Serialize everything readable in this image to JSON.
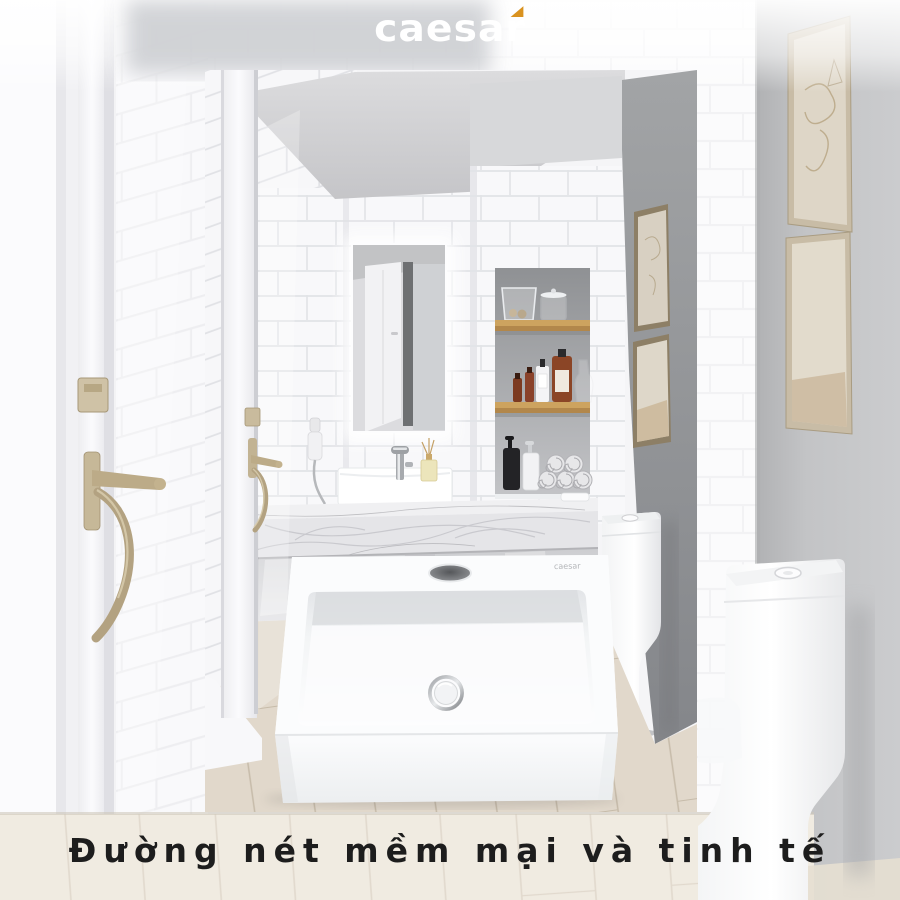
{
  "brand": {
    "logo_text": "caesar",
    "accent_color": "#d9921f",
    "sink_mark": "caesar"
  },
  "caption": {
    "text": "Đường nét mềm mại và tinh tế",
    "color": "#1d1d1d"
  },
  "palette": {
    "background_tile": "#f6f6f8",
    "grout": "#e4e4e8",
    "accent_wall_gray": "#97999b",
    "outer_wall_gray": "#bcbdbf",
    "ceiling_gray": "#cfcfd2",
    "marble": "#eeeef0",
    "wood_floor": "#ddd3c4",
    "wood_shelf": "#c59a58",
    "brass_handle": "#b3a281",
    "towel_gray": "#e6e6e8",
    "amber_bottle": "#8a4526",
    "product_white": "#ffffff"
  }
}
